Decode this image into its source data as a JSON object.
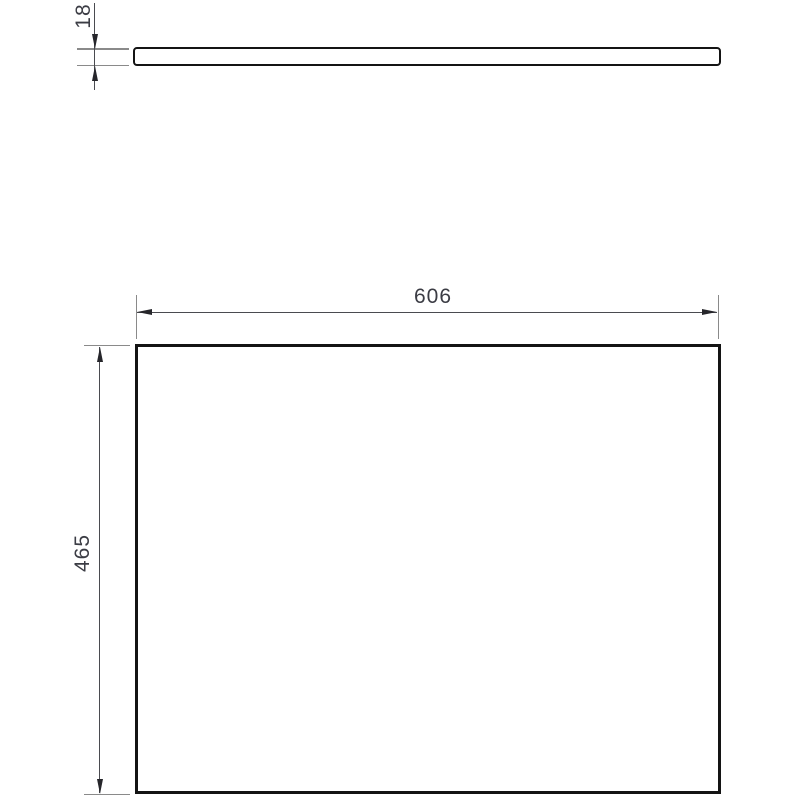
{
  "drawing": {
    "dimensions": {
      "thickness_label": "18",
      "width_label": "606",
      "height_label": "465"
    },
    "colors": {
      "background": "#ffffff",
      "part_outline": "#141414",
      "dimension_line": "#4a4b50",
      "extension_line": "#8a8a8a",
      "arrow": "#26262b",
      "label_text": "#3b3c44"
    }
  }
}
